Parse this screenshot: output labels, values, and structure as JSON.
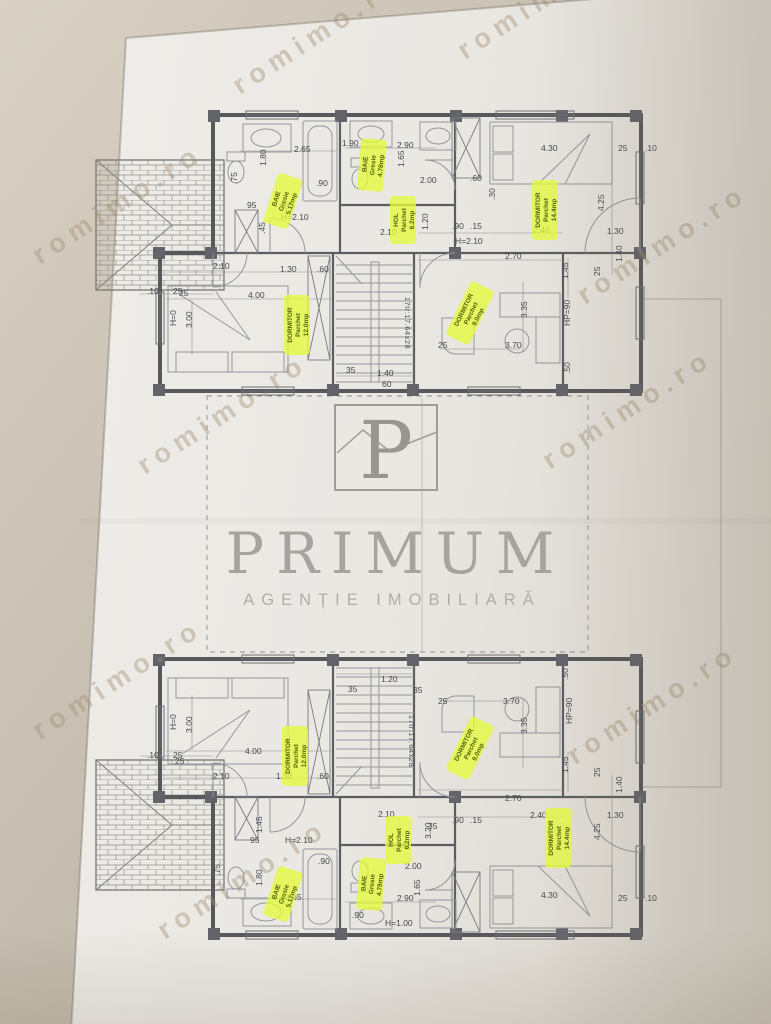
{
  "watermark": {
    "text": "romimo.ro"
  },
  "logo": {
    "letter": "P",
    "name": "PRIMUM",
    "tagline": "AGENȚIE IMOBILIARĂ"
  },
  "dims": {
    "d010": ".10",
    "d015": ".15",
    "d025": "25",
    "d030": ".30",
    "d035": "35",
    "d045": ".45",
    "d050": ".50",
    "d060": ".60",
    "d60": "60",
    "d075": ".75",
    "d080": ".80",
    "d090": ".90",
    "d095": "95",
    "d120": "1.20",
    "d130": "1.30",
    "d140": "1.40",
    "d145": "1.45",
    "d165": "1.65",
    "d180": "1.80",
    "d190": "1.90",
    "d200": "2.00",
    "d210": "2.10",
    "d240": "2.40",
    "d265": "2.65",
    "d270": "2.70",
    "d290": "2.90",
    "d300": "3.00",
    "d320": "3.20",
    "d335": "3.35",
    "d370": "3.70",
    "d400": "4.00",
    "d425": "4.25",
    "d430": "4.30",
    "h0": "H=0",
    "h100": "H=1.00",
    "h210": "H=2.10",
    "hp90": "HP=90"
  },
  "labels": {
    "baie1": [
      "BAIE",
      "Gresie",
      "5.17mp"
    ],
    "baie2": [
      "BAIE",
      "Gresie",
      "4.78mp"
    ],
    "hol": [
      "HOL",
      "Parchet",
      "6.2mp"
    ],
    "dormitor_left": [
      "DORMITOR",
      "Parchet",
      "12.0mp"
    ],
    "dormitor_center": [
      "DORMITOR",
      "Parchet",
      "9.0mp"
    ],
    "dormitor_right": [
      "DORMITOR",
      "Parchet",
      "14.4mp"
    ],
    "stairs": "17tr:17.64x28"
  }
}
